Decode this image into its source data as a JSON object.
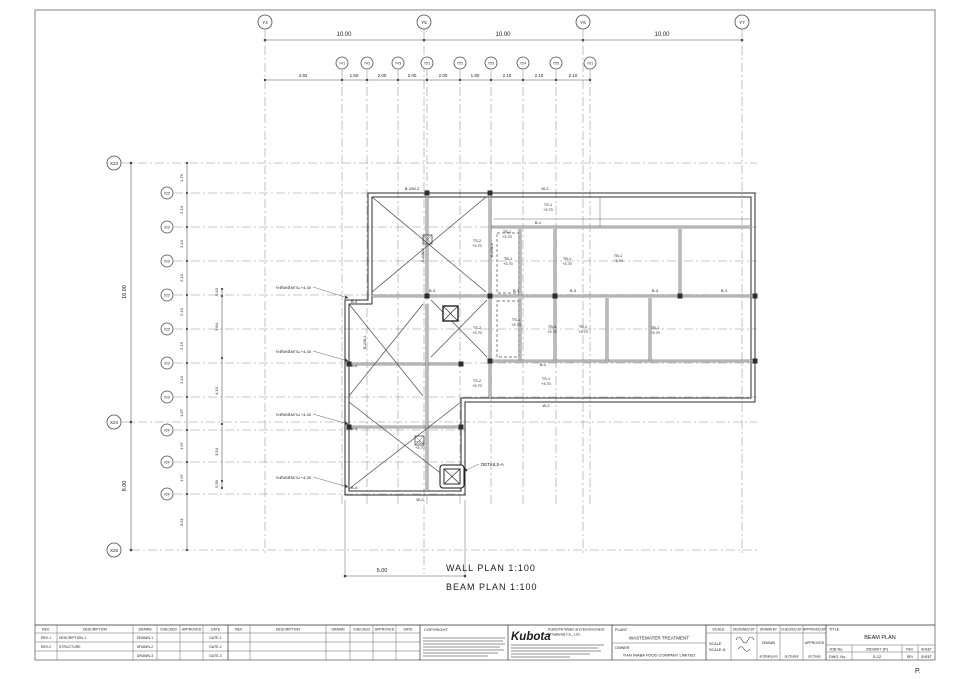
{
  "drawing": {
    "top_grid": {
      "main_bubbles": [
        "Y4",
        "Y5",
        "Y6",
        "Y7"
      ],
      "main_dims": [
        "10.00",
        "10.00",
        "10.00"
      ],
      "sub_bubbles": [
        "Y4'1",
        "Y4'2",
        "Y4'3",
        "Y5'1",
        "Y5'2",
        "Y5'3",
        "Y5'4",
        "Y5'5",
        "Y6'1"
      ],
      "sub_dims": [
        "4.92",
        "1.50",
        "2.00",
        "2.00",
        "2.00",
        "1.80",
        "2.10",
        "2.10",
        "2.10"
      ]
    },
    "left_grid": {
      "main_bubbles": [
        "X23",
        "X24",
        "X25"
      ],
      "main_dims": [
        "16.00",
        "8.00"
      ],
      "sub_bubbles": [
        "X23'",
        "X23'",
        "X23'",
        "X23'",
        "X23'",
        "X23'",
        "X23'",
        "X24'",
        "X24'",
        "X24'"
      ],
      "sub_dims": [
        "1.79",
        "2.14",
        "2.13",
        "2.13",
        "2.13",
        "2.13",
        "2.13",
        "1.97",
        "1.97",
        "1.97",
        "3.51"
      ],
      "detail_dims": [
        "0.43",
        "3.84",
        "4.10",
        "3.54",
        "0.39"
      ]
    },
    "plan": {
      "beams": {
        "b1": "B-1",
        "b3": "B-3",
        "b4": "B-4",
        "w2": "W-2",
        "b2w2": "B-2/W-2",
        "b2w1": "B-2/W-1"
      },
      "slabs": {
        "ts1": "TS-1",
        "ts2": "TS-2",
        "tb1": "TB-1",
        "level": "+3.70"
      },
      "notes": {
        "beam_level": "ระดับหลังคาน +4.30",
        "details": "DETAILS-A"
      }
    },
    "bottom_dim": "5.00",
    "captions": {
      "wall_plan": "WALL PLAN 1:100",
      "beam_plan": "BEAM PLAN 1:100",
      "page": "P."
    }
  },
  "title_block": {
    "rev_table": {
      "headers": [
        "REV.",
        "DESCRIPTION",
        "DRAWN",
        "CHECKED",
        "APPROVED",
        "DATE"
      ],
      "rows": [
        [
          "REV-1",
          "DESCRIPTION-1",
          "DRAWN-1",
          "",
          "",
          "DATE-1"
        ],
        [
          "REV-2",
          "STRUCTURE",
          "DRAWN-2",
          "",
          "",
          "DATE-2"
        ],
        [
          "",
          "",
          "DRAWN-3",
          "",
          "",
          "DATE-3"
        ]
      ]
    },
    "copyright": {
      "title": "COPYRIGHT"
    },
    "company": {
      "logo": "Kubota",
      "name_line1": "KUBOTA Water and Environment",
      "name_line2": "(Thailand) Co., Ltd."
    },
    "plant": {
      "label": "PLANT",
      "value": "WASTEWATER TREATMENT"
    },
    "owner": {
      "label": "OWNER",
      "value": "THAI INABA FOOD COMPANY LIMITED"
    },
    "scale": {
      "header": "SCALE",
      "line1": "SCALE",
      "line2": "SCALE-N"
    },
    "signatures": {
      "designed_by": "DESIGNED BY",
      "drawn_by": "DRAWN BY",
      "checked_by": "CHECKED BY",
      "approved_by": "APPROVED BY",
      "drawn_label": "DRAWN",
      "approved_label": "APPROVED",
      "drawn_name": "at.Dilumpurn",
      "checked_name": "at.Chabut",
      "approved_name": "at.Chuso"
    },
    "title": {
      "label": "TITLE",
      "value": "BEAM PLAN"
    },
    "job": {
      "label": "JOB No.",
      "value": "2503007 (P)"
    },
    "dwg": {
      "label": "DWG. No.",
      "value": "S-12"
    },
    "rev_sheet": {
      "rev_header": "REV.",
      "sheet_header": "SHEET",
      "rev_value": "REV",
      "sheet_value": "SHEET"
    }
  }
}
